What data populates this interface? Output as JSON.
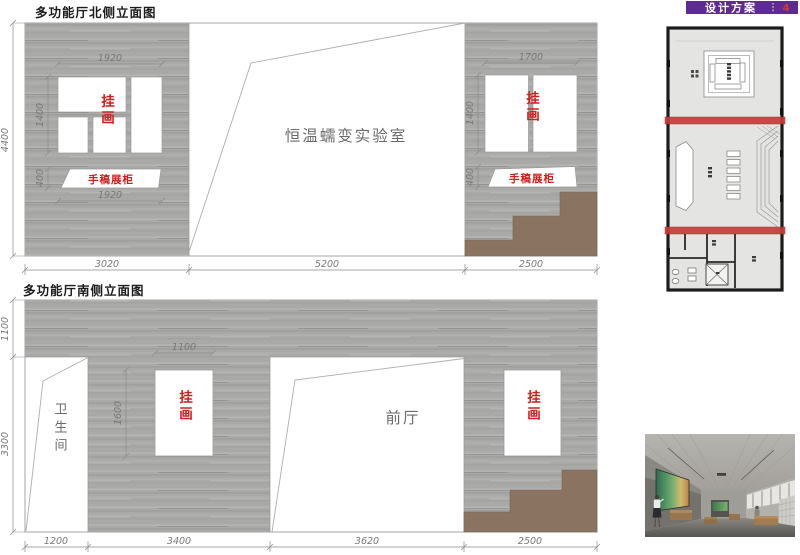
{
  "banner": {
    "title": "设计方案",
    "page": "4"
  },
  "north": {
    "title": "多功能厅北侧立面图",
    "room_label": "恒温蠕变实验室",
    "left_group": {
      "art_label": "挂画",
      "cabinet_label": "手稿展柜",
      "dim_width_top": "1920",
      "dim_height": "1400",
      "dim_cabinet_height": "400",
      "dim_width_bottom": "1920"
    },
    "right_group": {
      "art_label": "挂画",
      "cabinet_label": "手稿展柜",
      "dim_width_top": "1700",
      "dim_height": "1400",
      "dim_cabinet_height": "400"
    },
    "dim_total_height": "4400",
    "dims_bottom": [
      "3020",
      "5200",
      "2500"
    ]
  },
  "south": {
    "title": "多功能厅南侧立面图",
    "bathroom_label": "卫生间",
    "foyer_label": "前厅",
    "center_art": {
      "art_label": "挂画",
      "dim_width": "1100",
      "dim_height": "1600"
    },
    "right_art": {
      "art_label": "挂画"
    },
    "dims_left": [
      "1100",
      "3300"
    ],
    "dims_bottom": [
      "1200",
      "3400",
      "3620",
      "2500"
    ]
  },
  "colors": {
    "banner_purple": "#5e2b90",
    "page_number_red": "#d93a2b",
    "label_red": "#cc211c",
    "stair_brown": "#8b7361",
    "plan_band_red": "#c63c38",
    "wood_gray": "#a9a9a7",
    "dim_gray": "#787878"
  }
}
